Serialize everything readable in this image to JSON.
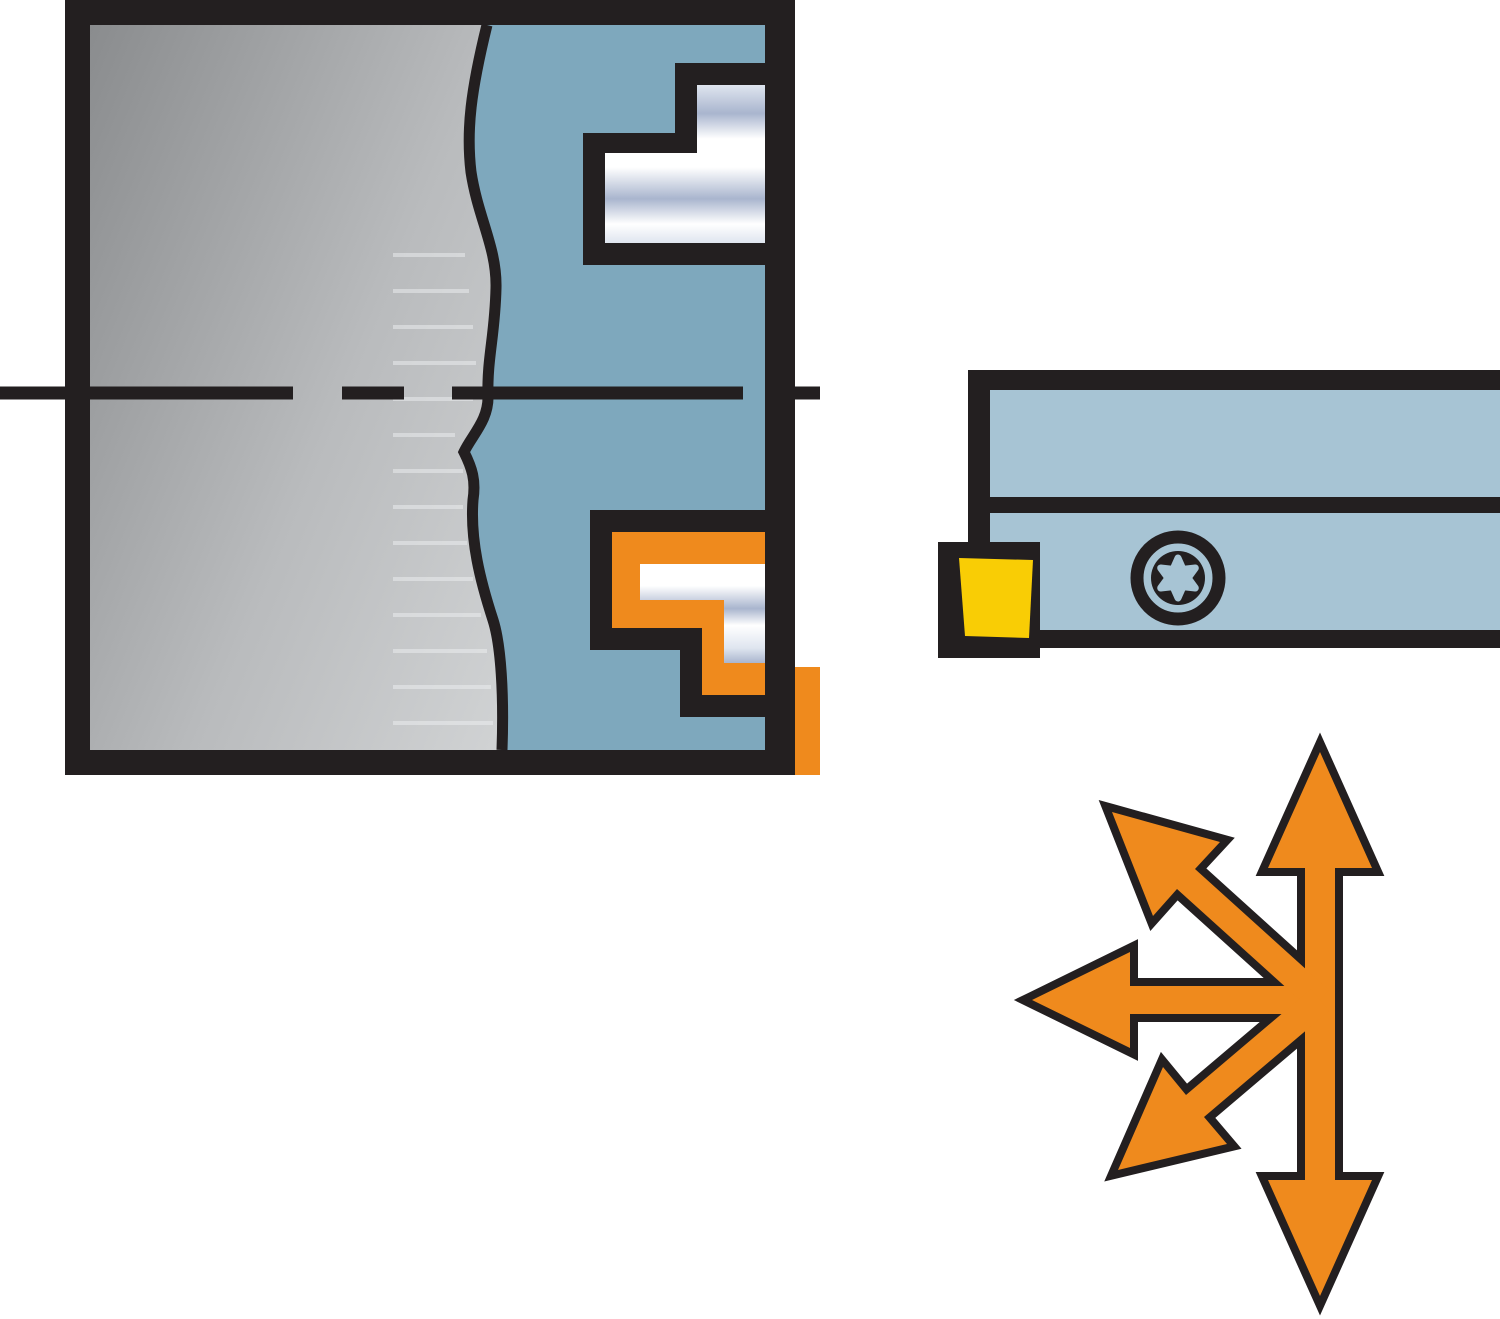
{
  "illustration": {
    "kind": "technical-catalog-drawing",
    "parts": {
      "workpiece": "workpiece cross-section with stepped bore profile",
      "allowance": "orange machining allowance band in lower groove profile",
      "toolholder": "grooving tool holder with clamped insert and torx screw",
      "feed_arrows": "multi-directional feed arrows"
    },
    "arrow_directions": [
      "up",
      "down",
      "left",
      "up-left",
      "down-left"
    ]
  },
  "colors": {
    "background": "#ffffff",
    "outline": "#231f20",
    "section_blue": "#7ea8bd",
    "holder_blue": "#a7c4d4",
    "insert_yellow": "#f9cd05",
    "accent_orange": "#ef8a1d",
    "gray_dark": "#8a8c8e",
    "gray_mid": "#b9bbbd",
    "gray_light": "#d8dadb",
    "metal_light": "#ffffff",
    "metal_mid": "#a9b5ce",
    "metal_soft": "#dfe5ef",
    "texture_line": "#eef0f2"
  }
}
